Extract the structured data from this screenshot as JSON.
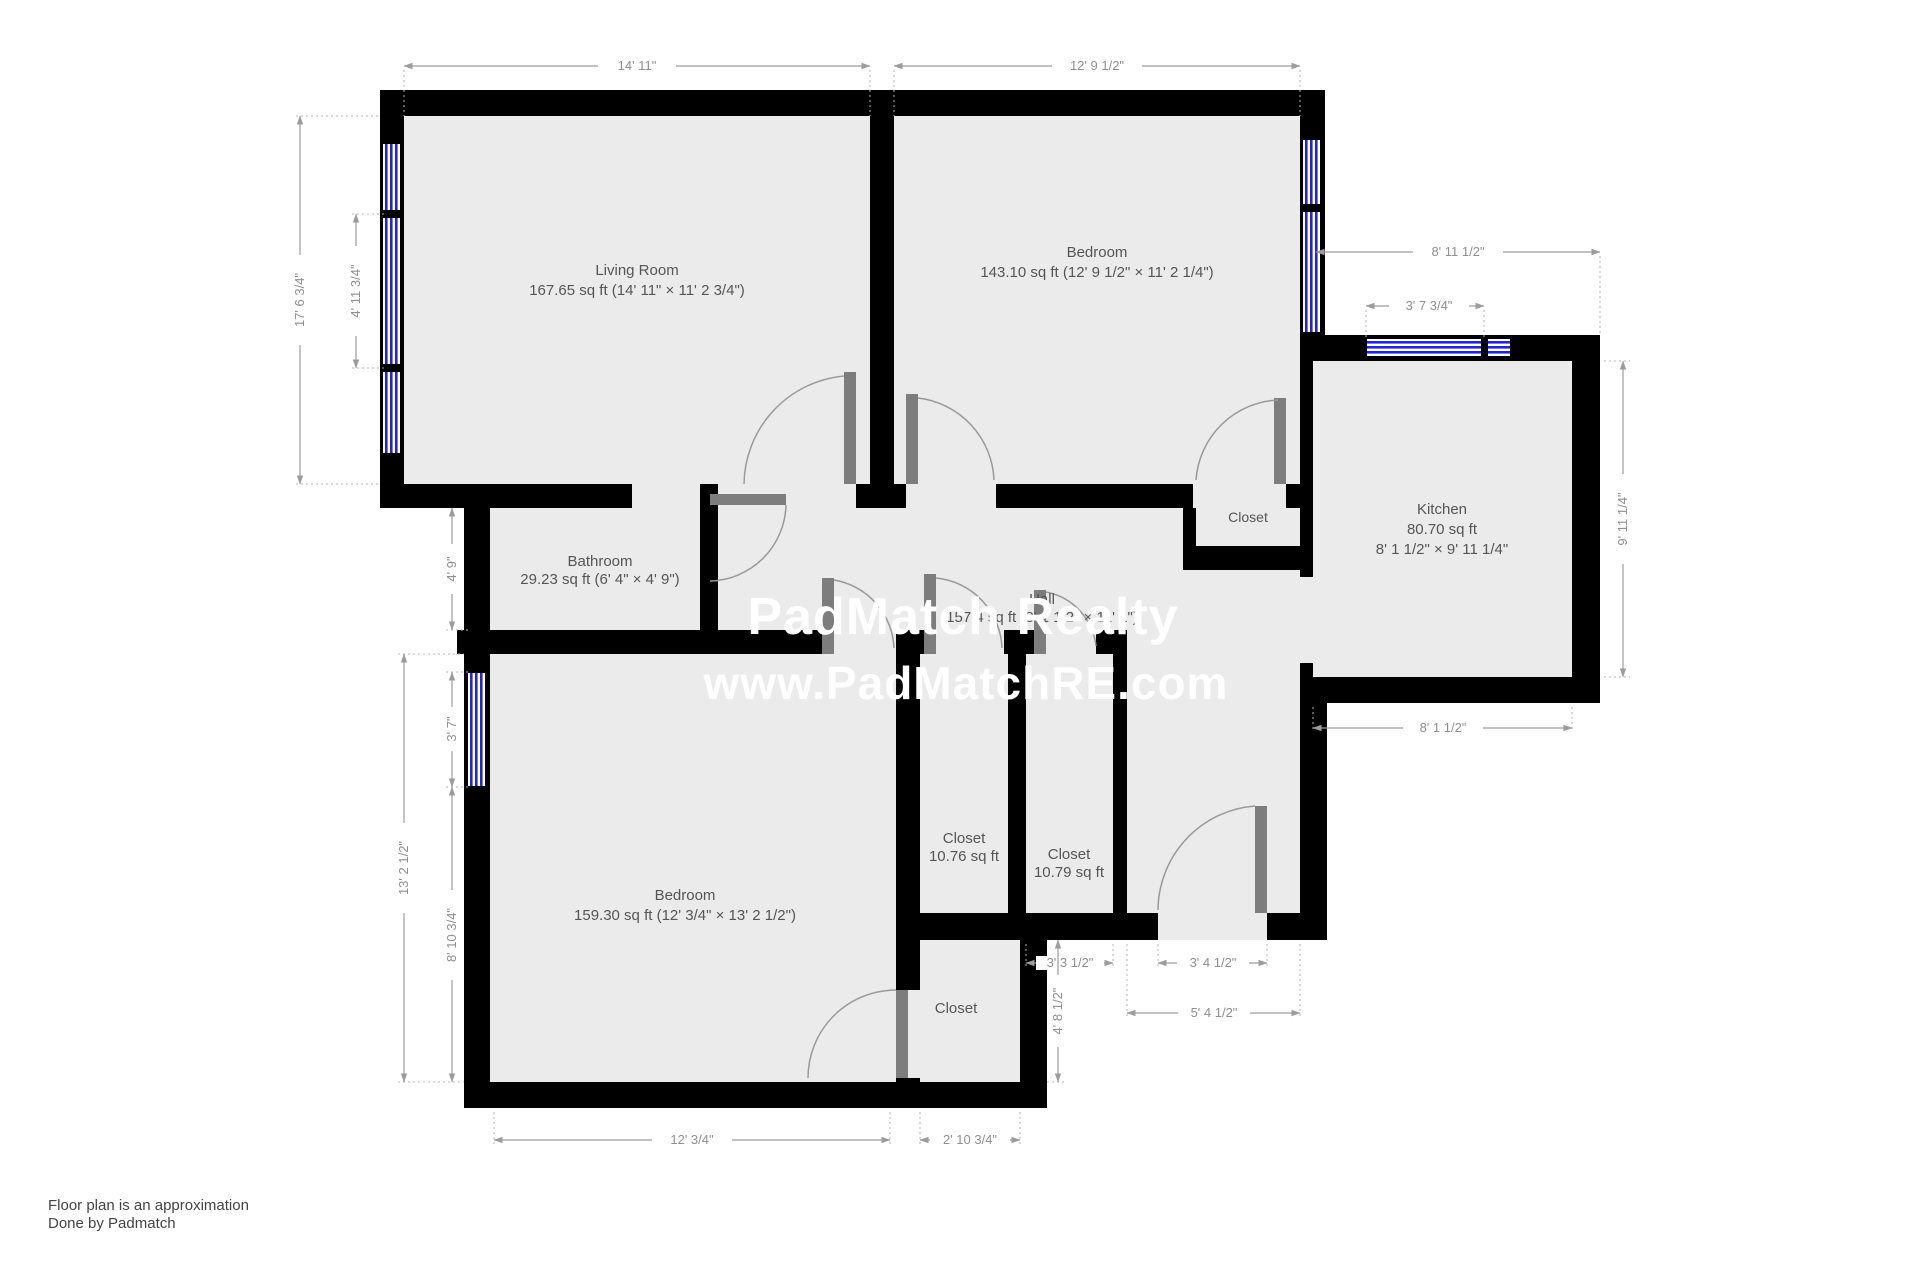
{
  "watermark": {
    "line1": "PadMatch Realty",
    "line2": "www.PadMatchRE.com"
  },
  "footer": {
    "line1": "Floor plan is an approximation",
    "line2": "Done by Padmatch"
  },
  "rooms": {
    "living": {
      "name": "Living Room",
      "details": "167.65 sq ft (14' 11\" × 11' 2 3/4\")"
    },
    "bedroom1": {
      "name": "Bedroom",
      "details": "143.10 sq ft (12' 9 1/2\" × 11' 2 1/4\")"
    },
    "bathroom": {
      "name": "Bathroom",
      "details": "29.23 sq ft (6' 4\" × 4' 9\")"
    },
    "kitchen": {
      "name": "Kitchen",
      "area": "80.70 sq ft",
      "dims": "8' 1 1/2\" × 9' 11 1/4\""
    },
    "hall": {
      "name": "Hall",
      "details": "157.4 sq ft (8' 2 1/2\" × 11' 1\")"
    },
    "bedroom2": {
      "name": "Bedroom",
      "details": "159.30 sq ft (12' 3/4\" × 13' 2 1/2\")"
    },
    "closet_tr": {
      "name": "Closet"
    },
    "closet1": {
      "name": "Closet",
      "area": "10.76 sq ft"
    },
    "closet2": {
      "name": "Closet",
      "area": "10.79 sq ft"
    },
    "closet3": {
      "name": "Closet"
    }
  },
  "dims": {
    "top_living": "14' 11\"",
    "top_bedroom": "12' 9 1/2\"",
    "living_height": "17' 6 3/4\"",
    "living_window": "4' 11 3/4\"",
    "bathroom_height": "4' 9\"",
    "bedroom2_height": "13' 2 1/2\"",
    "bedroom2_window": "3' 7\"",
    "bedroom2_lower": "8' 10 3/4\"",
    "right_upper": "8' 11 1/2\"",
    "kitchen_window": "3' 7 3/4\"",
    "kitchen_height": "9' 11 1/4\"",
    "kitchen_width": "8' 1 1/2\"",
    "bedroom2_width": "12' 3/4\"",
    "closet3_width": "2' 10 3/4\"",
    "closet2_width": "3' 3 1/2\"",
    "entry_door": "3' 4 1/2\"",
    "entry_bay": "5' 4 1/2\"",
    "step_height": "4' 8 1/2\""
  },
  "colors": {
    "wall": "#000000",
    "floor": "#ebebeb",
    "window": "#2525cf",
    "door": "#7d7d7d",
    "dim": "#9c9c9c",
    "label": "#555555",
    "watermark": "#ffffff"
  }
}
